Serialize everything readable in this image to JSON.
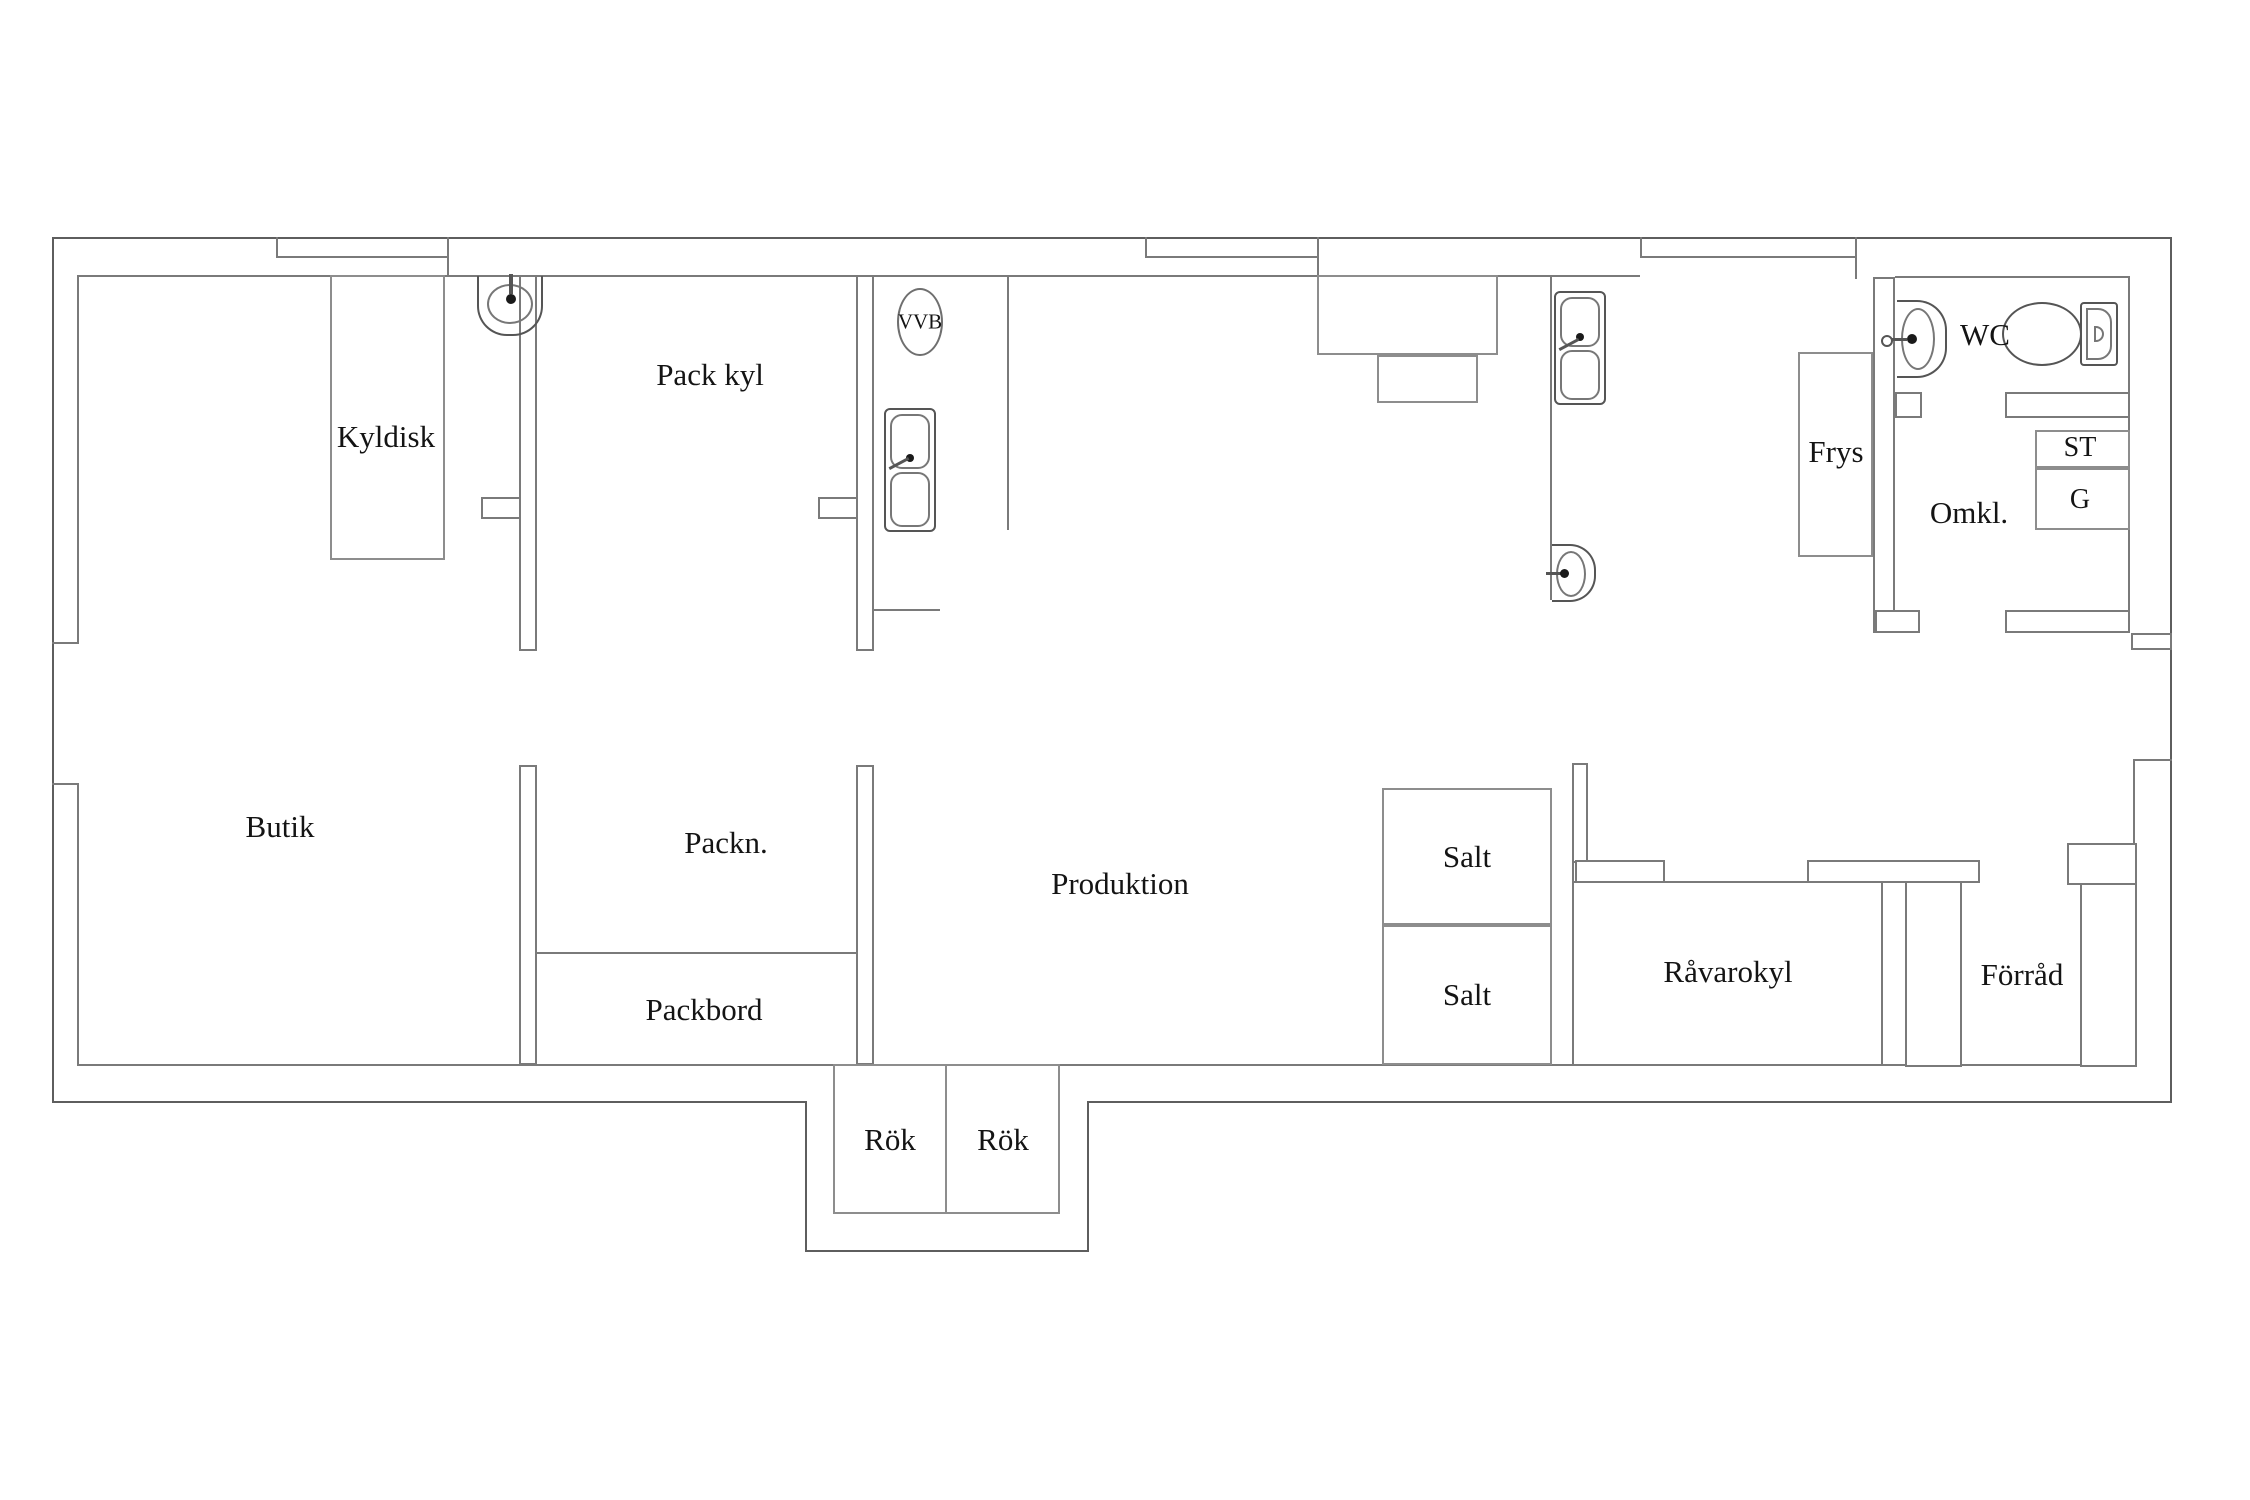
{
  "document": {
    "type": "floor-plan",
    "language": "sv"
  },
  "colors": {
    "background": "#ffffff",
    "wall": "#7a7a7a",
    "wall_dark": "#5e5e5e",
    "text": "#141414"
  },
  "rooms": {
    "kyldisk": {
      "label": "Kyldisk"
    },
    "pack_kyl": {
      "label": "Pack kyl"
    },
    "vvb": {
      "label": "VVB"
    },
    "butik": {
      "label": "Butik"
    },
    "packn": {
      "label": "Packn."
    },
    "packbord": {
      "label": "Packbord"
    },
    "produktion": {
      "label": "Produktion"
    },
    "salt_upper": {
      "label": "Salt"
    },
    "salt_lower": {
      "label": "Salt"
    },
    "rok_left": {
      "label": "Rök"
    },
    "rok_right": {
      "label": "Rök"
    },
    "ravarokyl": {
      "label": "Råvarokyl"
    },
    "forrad": {
      "label": "Förråd"
    },
    "frys": {
      "label": "Frys"
    },
    "wc": {
      "label": "WC"
    },
    "omkl": {
      "label": "Omkl."
    },
    "st": {
      "label": "ST"
    },
    "g": {
      "label": "G"
    }
  },
  "fixtures": {
    "top_left_sink": "wall-mounted hand basin",
    "corridor_double_sink": "double basin sink unit",
    "right_double_sink": "double basin sink unit",
    "oval_hand_basin": "wall-mounted oval hand basin",
    "wc_washbasin": "wash basin",
    "toilet": "toilet with cistern",
    "vvb_unit": "hot water heater (circle symbol)"
  }
}
